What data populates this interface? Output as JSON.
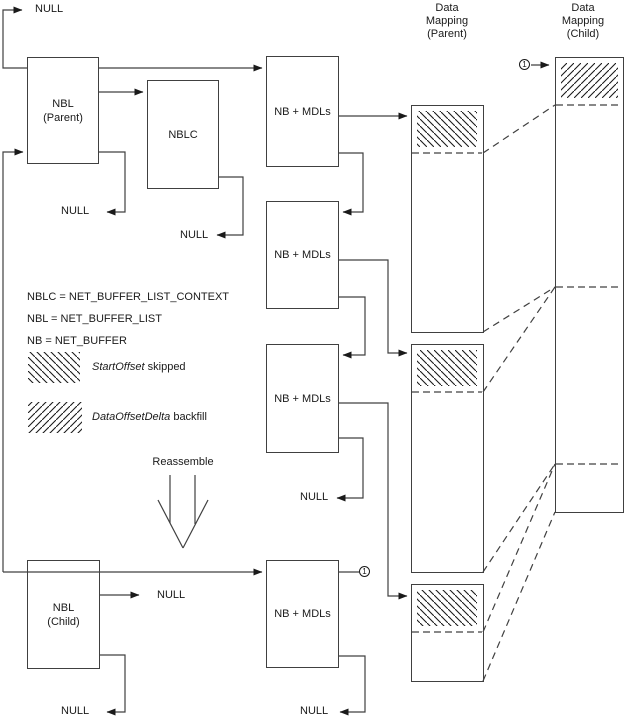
{
  "nodes": {
    "nbl_parent": "NBL\n(Parent)",
    "nblc": "NBLC",
    "nb_mdls": "NB + MDLs",
    "nbl_child": "NBL\n(Child)"
  },
  "headers": {
    "parent": "Data\nMapping\n(Parent)",
    "child": "Data\nMapping\n(Child)"
  },
  "labels": {
    "null_text": "NULL"
  },
  "legend": {
    "definitions": [
      "NBLC = NET_BUFFER_LIST_CONTEXT",
      "NBL = NET_BUFFER_LIST",
      "NB = NET_BUFFER"
    ],
    "start_offset": {
      "term": "StartOffset",
      "rest": " skipped",
      "pattern": "backslash-hatch"
    },
    "data_offset_delta": {
      "term": "DataOffsetDelta",
      "rest": " backfill",
      "pattern": "forward-hatch"
    }
  },
  "annotations": {
    "reassemble": "Reassemble",
    "marker": "1"
  },
  "colors": {
    "line": "#404040",
    "text": "#1a1a1a",
    "background": "#ffffff"
  }
}
